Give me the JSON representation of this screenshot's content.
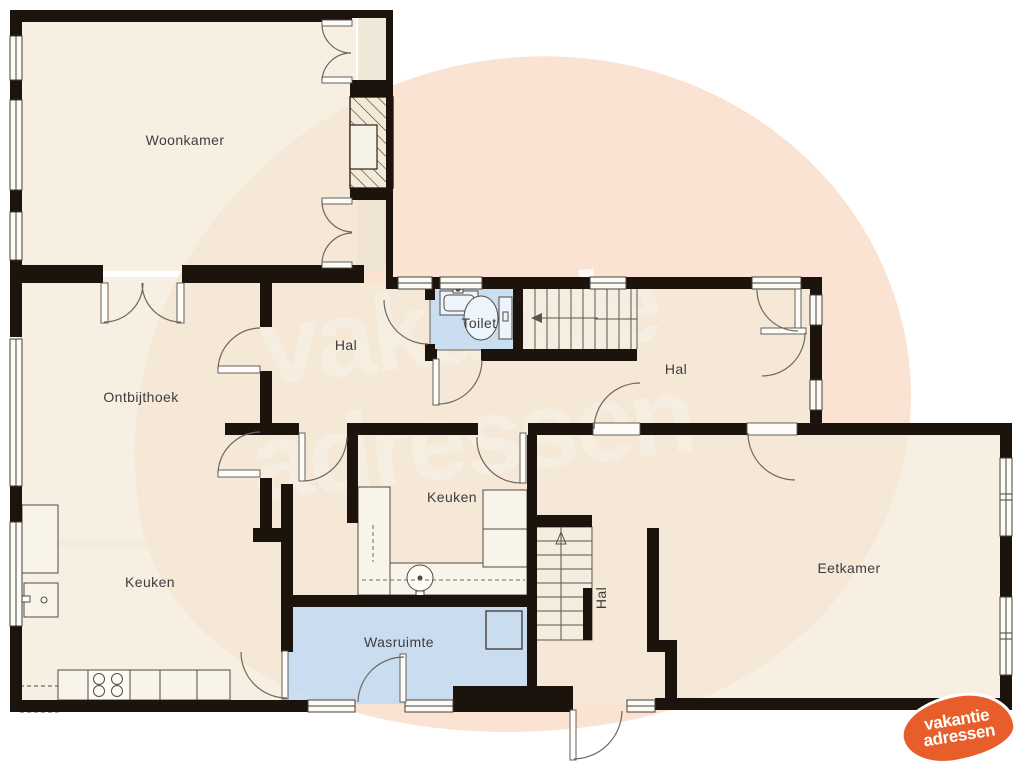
{
  "watermark": {
    "line1": "vakantie",
    "line2": "adressen"
  },
  "logo": {
    "line1": "vakantie",
    "line2": "adressen"
  },
  "rooms": [
    {
      "id": "woonkamer",
      "label": "Woonkamer"
    },
    {
      "id": "ontbijthoek",
      "label": "Ontbijthoek"
    },
    {
      "id": "hal-boven",
      "label": "Hal"
    },
    {
      "id": "toilet",
      "label": "Toilet"
    },
    {
      "id": "hal-rechts",
      "label": "Hal"
    },
    {
      "id": "keuken-midden",
      "label": "Keuken"
    },
    {
      "id": "keuken-links",
      "label": "Keuken"
    },
    {
      "id": "wasruimte",
      "label": "Wasruimte"
    },
    {
      "id": "hal-onder",
      "label": "Hal"
    },
    {
      "id": "eetkamer",
      "label": "Eetkamer"
    }
  ],
  "colors": {
    "wall": "#1c130c",
    "room_fill": "#f3ead8",
    "wet_room_fill": "#c6dcf2",
    "watermark_blob": "#fbe3d3",
    "watermark_text": "#f7e9de",
    "logo_orange": "#e85e2b",
    "label_text": "#3d3d3d"
  }
}
